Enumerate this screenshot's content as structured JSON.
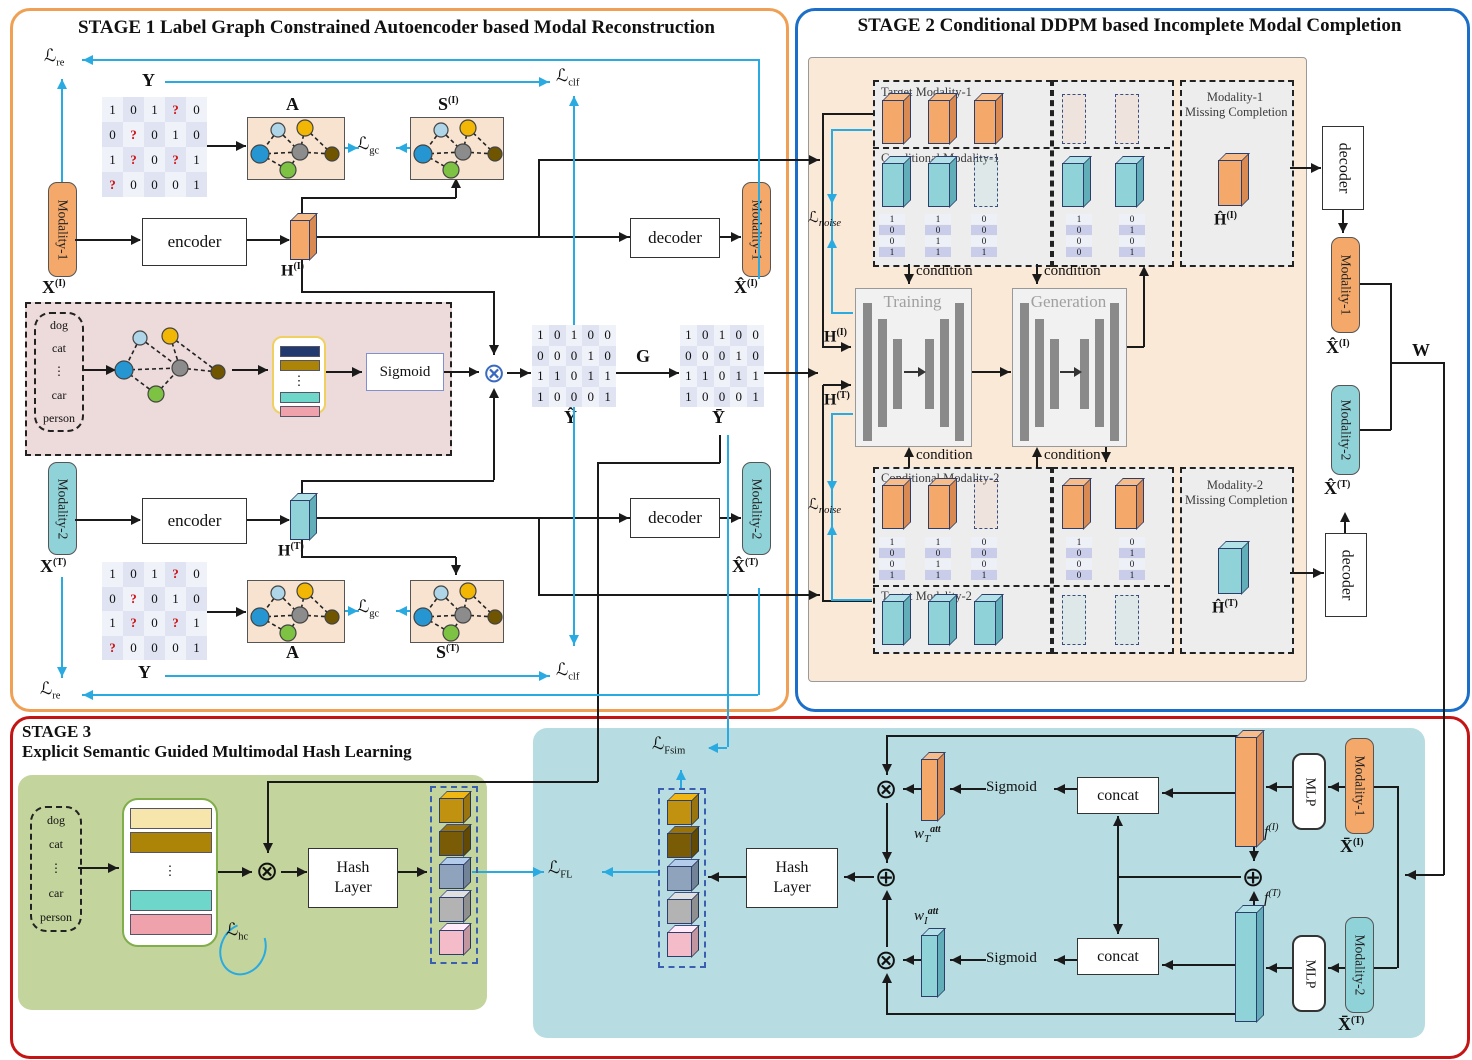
{
  "stage1": {
    "title": "STAGE 1    Label Graph Constrained Autoencoder based Modal Reconstruction"
  },
  "stage2": {
    "title": "STAGE 2  Conditional DDPM based Incomplete Modal Completion"
  },
  "stage3": {
    "title_line1": "STAGE 3",
    "title_line2": "Explicit Semantic Guided Multimodal Hash Learning"
  },
  "labels": {
    "encoder": "encoder",
    "decoder": "decoder",
    "sigmoid": "Sigmoid",
    "concat": "concat",
    "hash_layer_line1": "Hash",
    "hash_layer_line2": "Layer",
    "modality1": "Modality-1",
    "modality2": "Modality-2",
    "category": "Category",
    "pseudo_title_line1": "Label Co-occurrence based Pseudo Label",
    "pseudo_title_line2": "Generation",
    "gat": "Graph Attention Network",
    "training": "Training",
    "generation": "Generation",
    "condition": "condition",
    "target_modality1": "Target Modality-1",
    "conditional_modality1": "Conditional Modality-1",
    "conditional_modality2": "Conditional Modality-2",
    "target_modality2": "Target Modality-2",
    "m1_missing_line1": "Modality-1",
    "m1_missing_line2": "Missing Completion",
    "m2_missing_line1": "Modality-2",
    "m2_missing_line2": "Missing Completion",
    "discriminant": "Discriminant Hash Center",
    "fusion": "Multimodal Fusion Hash Learning",
    "mlp": "MLP"
  },
  "symbols": {
    "Y": "Y",
    "A": "A",
    "S": "S",
    "C": "C",
    "G": "G",
    "W": "W",
    "H": "H",
    "X": "X",
    "f": "f",
    "w": "w",
    "Yhat": "Ŷ",
    "Ybar": "Ȳ",
    "Xhat": "X̂",
    "Xbar": "X̄",
    "Hhat": "Ĥ",
    "sup_I": "(I)",
    "sup_T": "(T)",
    "sup_L": "L",
    "sup_att": "att",
    "sub_T": "T",
    "sub_I": "I",
    "loss": "ℒ",
    "sub_re": "re",
    "sub_clf": "clf",
    "sub_gc": "gc",
    "sub_noise": "noise",
    "sub_hc": "hc",
    "sub_FL": "FL",
    "sub_Fsim": "Fsim"
  },
  "category_items": [
    "dog",
    "cat",
    "⋮",
    "car",
    "person"
  ],
  "matrices": {
    "incomplete_label_matrix": [
      [
        "1",
        "0",
        "1",
        "?",
        "0"
      ],
      [
        "0",
        "?",
        "0",
        "1",
        "0"
      ],
      [
        "1",
        "?",
        "0",
        "?",
        "1"
      ],
      [
        "?",
        "0",
        "0",
        "0",
        "1"
      ]
    ],
    "pseudo_label_matrix": [
      [
        "1",
        "0",
        "1",
        "0",
        "0"
      ],
      [
        "0",
        "0",
        "0",
        "1",
        "0"
      ],
      [
        "1",
        "1",
        "0",
        "1",
        "1"
      ],
      [
        "1",
        "0",
        "0",
        "0",
        "1"
      ]
    ],
    "binary_codes": [
      [
        "1",
        "0",
        "0",
        "1"
      ],
      [
        "1",
        "0",
        "1",
        "1"
      ],
      [
        "0",
        "0",
        "0",
        "1"
      ],
      [
        "1",
        "0",
        "0",
        "0"
      ],
      [
        "0",
        "1",
        "0",
        "1"
      ]
    ]
  },
  "stage2_bars": {
    "target_m1": [
      "solid",
      "solid",
      "solid"
    ],
    "target_m1_right": [
      "dashed",
      "dashed"
    ],
    "cond_m1": [
      "solid",
      "solid",
      "dashed"
    ],
    "cond_m1_right": [
      "solid",
      "solid"
    ],
    "cond_m2": [
      "solid",
      "solid",
      "dashed"
    ],
    "cond_m2_right": [
      "solid",
      "solid"
    ],
    "target_m2": [
      "solid",
      "solid",
      "solid"
    ],
    "target_m2_right": [
      "dashed",
      "dashed"
    ]
  },
  "hash_cubes": [
    "gold",
    "darkgold",
    "bluegray",
    "gray",
    "pink"
  ],
  "c_bars": [
    "navy",
    "gold",
    "dots",
    "teal",
    "pink"
  ],
  "cl_bars": [
    "lightyellow",
    "gold",
    "dots",
    "teal",
    "pink"
  ],
  "colors": {
    "stage1_border": "#f0a055",
    "stage2_border": "#1b6fc8",
    "stage3_border": "#c41414",
    "cyan": "#29abe2",
    "black_line": "#1a1a1a",
    "orange": "#f4a869",
    "teal_fill": "#8fd2d8",
    "peach_bg": "#fbe9d8",
    "pink_bg": "#eddada",
    "green_bg": "#c3d49c",
    "teal_bg": "#b7dde2",
    "section_bg": "#ededed",
    "question_red": "#cc1111",
    "graph_nodes": {
      "lightblue": "#aed6e8",
      "yellow": "#f2b705",
      "blue": "#2596d1",
      "gray": "#8c8c8c",
      "green": "#7dc242",
      "olive": "#6f5500"
    },
    "bar_colors": {
      "navy": "#223a6e",
      "gold": "#ab8408",
      "lightyellow": "#f7e6ac",
      "teal": "#6fd6ca",
      "pink": "#f0a2ac"
    },
    "cube_colors": {
      "gold": "#c09210",
      "darkgold": "#7a5c06",
      "bluegray": "#8fa3bd",
      "gray": "#b3b3b3",
      "pink": "#f3bcc8"
    }
  }
}
